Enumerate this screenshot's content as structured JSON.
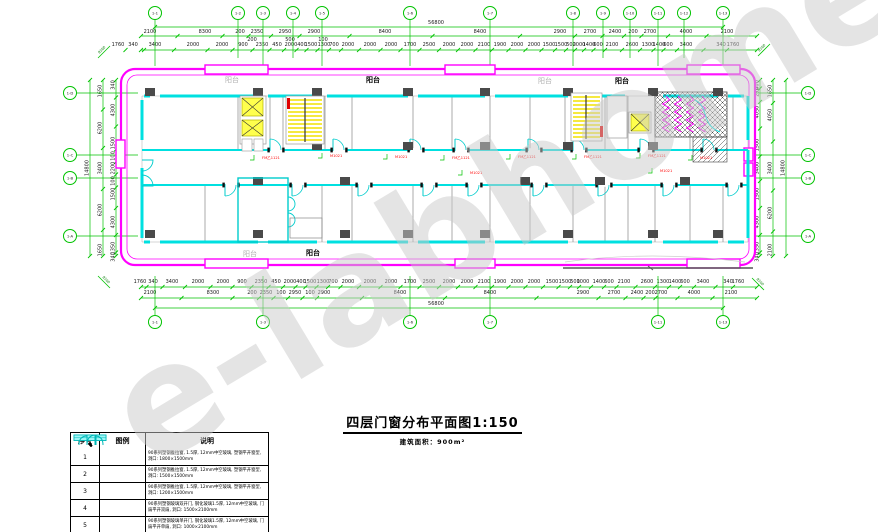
{
  "watermark": "e-labhome",
  "title": {
    "text": "四层门窗分布平面图1:150",
    "subtitle": "建筑面积：900m²"
  },
  "legend": {
    "headers": [
      "序号",
      "图例",
      "说明"
    ],
    "rows": [
      {
        "no": "1",
        "symbol": "window",
        "desc": "90系列塑钢推拉窗, 1.5厚, 12mm中空玻璃, 塑钢平开窗型, 洞口: 1800×1500mm"
      },
      {
        "no": "2",
        "symbol": "window",
        "desc": "90系列塑钢推拉窗, 1.5厚, 12mm中空玻璃, 塑钢平开窗型, 洞口: 1500×1500mm"
      },
      {
        "no": "3",
        "symbol": "window",
        "desc": "90系列塑钢推拉窗, 1.5厚, 12mm中空玻璃, 塑钢平开窗型, 洞口: 1200×1500mm"
      },
      {
        "no": "4",
        "symbol": "double-door",
        "desc": "90系列塑钢玻璃双开门, 钢化玻璃1.5厚, 12mm中空玻璃, 门扇平开双扇, 洞口: 1500×2100mm"
      },
      {
        "no": "5",
        "symbol": "single-door",
        "desc": "90系列塑钢玻璃单开门, 钢化玻璃1.5厚, 12mm中空玻璃, 门扇平开单扇, 洞口: 1000×2100mm"
      }
    ]
  },
  "drawing": {
    "balcony_labels": [
      {
        "text": "阳台",
        "x": 232,
        "y": 82,
        "shade": "light"
      },
      {
        "text": "阳台",
        "x": 373,
        "y": 82,
        "shade": "dark"
      },
      {
        "text": "阳台",
        "x": 545,
        "y": 83,
        "shade": "light"
      },
      {
        "text": "阳台",
        "x": 622,
        "y": 83,
        "shade": "dark"
      },
      {
        "text": "阳台",
        "x": 250,
        "y": 256,
        "shade": "light"
      },
      {
        "text": "阳台",
        "x": 313,
        "y": 255,
        "shade": "dark"
      }
    ],
    "grid_bubbles": {
      "top": {
        "cy": 13,
        "stem": [
          20,
          58
        ],
        "main_stem": 66,
        "items": [
          {
            "x": 155,
            "label": "1-1",
            "main": true
          },
          {
            "x": 238,
            "label": "1-2"
          },
          {
            "x": 263,
            "label": "1-3",
            "main": true
          },
          {
            "x": 293,
            "label": "1-4"
          },
          {
            "x": 322,
            "label": "1-5",
            "main": true
          },
          {
            "x": 410,
            "label": "1-6",
            "main": true
          },
          {
            "x": 490,
            "label": "1-7",
            "main": true
          },
          {
            "x": 573,
            "label": "1-8",
            "main": true
          },
          {
            "x": 603,
            "label": "1-9"
          },
          {
            "x": 630,
            "label": "1-10"
          },
          {
            "x": 658,
            "label": "1-11",
            "main": true
          },
          {
            "x": 684,
            "label": "1-12"
          },
          {
            "x": 723,
            "label": "1-13",
            "main": true
          }
        ]
      },
      "bottom": {
        "cy": 322,
        "stem": [
          276,
          315
        ],
        "main_stem": 276,
        "items": [
          {
            "x": 155,
            "label": "1-1"
          },
          {
            "x": 263,
            "label": "1-3"
          },
          {
            "x": 410,
            "label": "1-6"
          },
          {
            "x": 490,
            "label": "1-7"
          },
          {
            "x": 658,
            "label": "1-11"
          },
          {
            "x": 723,
            "label": "1-13"
          }
        ]
      },
      "left": {
        "cx": 70,
        "stem": [
          77,
          138
        ],
        "items": [
          {
            "y": 93,
            "label": "1-D"
          },
          {
            "y": 155,
            "label": "1-C"
          },
          {
            "y": 178,
            "label": "1-B"
          },
          {
            "y": 236,
            "label": "1-A"
          }
        ]
      },
      "right": {
        "cx": 808,
        "stem": [
          755,
          801
        ],
        "items": [
          {
            "y": 93,
            "label": "1-D"
          },
          {
            "y": 155,
            "label": "1-C"
          },
          {
            "y": 178,
            "label": "1-B"
          },
          {
            "y": 236,
            "label": "1-A"
          }
        ]
      }
    },
    "dim_rows_h": [
      {
        "y": 24,
        "line": {
          "y": 27,
          "x1": 155,
          "x2": 723
        },
        "items": [
          {
            "x": 436,
            "label": "56800"
          }
        ]
      },
      {
        "y": 33,
        "line": {
          "y": 36,
          "x1": 141,
          "x2": 757
        },
        "items": [
          {
            "x": 150,
            "label": "2100"
          },
          {
            "x": 205,
            "label": "8300"
          },
          {
            "x": 240,
            "label": "200"
          },
          {
            "x": 257,
            "label": "2350"
          },
          {
            "x": 285,
            "label": "2950"
          },
          {
            "x": 314,
            "label": "2900"
          },
          {
            "x": 385,
            "label": "8400"
          },
          {
            "x": 480,
            "label": "8400"
          },
          {
            "x": 560,
            "label": "2900"
          },
          {
            "x": 590,
            "label": "2700"
          },
          {
            "x": 615,
            "label": "2400"
          },
          {
            "x": 633,
            "label": "200"
          },
          {
            "x": 650,
            "label": "2700"
          },
          {
            "x": 686,
            "label": "4000"
          },
          {
            "x": 727,
            "label": "2100"
          }
        ]
      },
      {
        "y": 41,
        "items": [
          {
            "x": 252,
            "label": "200"
          },
          {
            "x": 290,
            "label": "500"
          },
          {
            "x": 323,
            "label": "100"
          }
        ]
      },
      {
        "y": 46,
        "line": {
          "y": 50,
          "x1": 141,
          "x2": 757
        },
        "items": [
          {
            "x": 118,
            "label": "1760"
          },
          {
            "x": 133,
            "label": "340"
          },
          {
            "x": 155,
            "label": "3400"
          },
          {
            "x": 193,
            "label": "2000"
          },
          {
            "x": 222,
            "label": "2000"
          },
          {
            "x": 243,
            "label": "900"
          },
          {
            "x": 262,
            "label": "2350"
          },
          {
            "x": 277,
            "label": "450"
          },
          {
            "x": 291,
            "label": "2000"
          },
          {
            "x": 302,
            "label": "400"
          },
          {
            "x": 311,
            "label": "1500"
          },
          {
            "x": 324,
            "label": "1300"
          },
          {
            "x": 334,
            "label": "700"
          },
          {
            "x": 348,
            "label": "2000"
          },
          {
            "x": 370,
            "label": "2000"
          },
          {
            "x": 391,
            "label": "2000"
          },
          {
            "x": 410,
            "label": "1700"
          },
          {
            "x": 429,
            "label": "2500"
          },
          {
            "x": 449,
            "label": "2000"
          },
          {
            "x": 467,
            "label": "2000"
          },
          {
            "x": 484,
            "label": "2100"
          },
          {
            "x": 500,
            "label": "1900"
          },
          {
            "x": 517,
            "label": "2000"
          },
          {
            "x": 534,
            "label": "2000"
          },
          {
            "x": 549,
            "label": "1500"
          },
          {
            "x": 561,
            "label": "1500"
          },
          {
            "x": 571,
            "label": "500"
          },
          {
            "x": 579,
            "label": "2000"
          },
          {
            "x": 589,
            "label": "1400"
          },
          {
            "x": 598,
            "label": "600"
          },
          {
            "x": 612,
            "label": "2100"
          },
          {
            "x": 632,
            "label": "2600"
          },
          {
            "x": 648,
            "label": "1300"
          },
          {
            "x": 659,
            "label": "1400"
          },
          {
            "x": 668,
            "label": "600"
          },
          {
            "x": 686,
            "label": "3400"
          },
          {
            "x": 721,
            "label": "340"
          },
          {
            "x": 733,
            "label": "1760"
          }
        ]
      },
      {
        "y": 283,
        "line": {
          "y": 287,
          "x1": 141,
          "x2": 757
        },
        "items": [
          {
            "x": 140,
            "label": "1760"
          },
          {
            "x": 153,
            "label": "340"
          },
          {
            "x": 172,
            "label": "3400"
          },
          {
            "x": 198,
            "label": "2000"
          },
          {
            "x": 223,
            "label": "2000"
          },
          {
            "x": 242,
            "label": "900"
          },
          {
            "x": 261,
            "label": "2350"
          },
          {
            "x": 276,
            "label": "450"
          },
          {
            "x": 290,
            "label": "2000"
          },
          {
            "x": 301,
            "label": "400"
          },
          {
            "x": 310,
            "label": "1500"
          },
          {
            "x": 323,
            "label": "1300"
          },
          {
            "x": 333,
            "label": "700"
          },
          {
            "x": 348,
            "label": "2000"
          },
          {
            "x": 370,
            "label": "2000"
          },
          {
            "x": 391,
            "label": "2000"
          },
          {
            "x": 410,
            "label": "1700"
          },
          {
            "x": 429,
            "label": "2500"
          },
          {
            "x": 449,
            "label": "2000"
          },
          {
            "x": 467,
            "label": "2000"
          },
          {
            "x": 484,
            "label": "2100"
          },
          {
            "x": 500,
            "label": "1900"
          },
          {
            "x": 517,
            "label": "2000"
          },
          {
            "x": 534,
            "label": "2000"
          },
          {
            "x": 552,
            "label": "1500"
          },
          {
            "x": 565,
            "label": "1500"
          },
          {
            "x": 575,
            "label": "500"
          },
          {
            "x": 583,
            "label": "1000"
          },
          {
            "x": 599,
            "label": "1400"
          },
          {
            "x": 609,
            "label": "600"
          },
          {
            "x": 624,
            "label": "2100"
          },
          {
            "x": 647,
            "label": "2600"
          },
          {
            "x": 663,
            "label": "1300"
          },
          {
            "x": 675,
            "label": "1400"
          },
          {
            "x": 685,
            "label": "600"
          },
          {
            "x": 703,
            "label": "3400"
          },
          {
            "x": 728,
            "label": "340"
          },
          {
            "x": 738,
            "label": "1760"
          }
        ]
      },
      {
        "y": 294,
        "line": {
          "y": 298,
          "x1": 141,
          "x2": 757
        },
        "items": [
          {
            "x": 150,
            "label": "2100"
          },
          {
            "x": 213,
            "label": "8300"
          },
          {
            "x": 252,
            "label": "200"
          },
          {
            "x": 266,
            "label": "2350"
          },
          {
            "x": 281,
            "label": "100"
          },
          {
            "x": 295,
            "label": "2950"
          },
          {
            "x": 310,
            "label": "100"
          },
          {
            "x": 324,
            "label": "2900"
          },
          {
            "x": 400,
            "label": "8400"
          },
          {
            "x": 490,
            "label": "8400"
          },
          {
            "x": 583,
            "label": "2900"
          },
          {
            "x": 614,
            "label": "2700"
          },
          {
            "x": 637,
            "label": "2400"
          },
          {
            "x": 650,
            "label": "200"
          },
          {
            "x": 661,
            "label": "2700"
          },
          {
            "x": 694,
            "label": "4000"
          },
          {
            "x": 731,
            "label": "2100"
          }
        ]
      },
      {
        "y": 305,
        "line": {
          "y": 308,
          "x1": 155,
          "x2": 723
        },
        "items": [
          {
            "x": 436,
            "label": "56800"
          }
        ]
      }
    ],
    "dim_cols_v": [
      {
        "x": 90,
        "y1": 80,
        "y2": 256,
        "items": [
          {
            "y": 168,
            "label": "14800"
          }
        ]
      },
      {
        "x": 103,
        "y1": 80,
        "y2": 256,
        "items": [
          {
            "y": 91,
            "label": "1650"
          },
          {
            "y": 128,
            "label": "6200"
          },
          {
            "y": 168,
            "label": "3400"
          },
          {
            "y": 210,
            "label": "6200"
          },
          {
            "y": 250,
            "label": "1650"
          }
        ]
      },
      {
        "x": 116,
        "y1": 80,
        "y2": 256,
        "items": [
          {
            "y": 85,
            "label": "340"
          },
          {
            "y": 110,
            "label": "4300"
          },
          {
            "y": 143,
            "label": "1500"
          },
          {
            "y": 156,
            "label": "100"
          },
          {
            "y": 168,
            "label": "2200"
          },
          {
            "y": 181,
            "label": "100"
          },
          {
            "y": 194,
            "label": "1500"
          },
          {
            "y": 222,
            "label": "4300"
          },
          {
            "y": 248,
            "label": "1350"
          },
          {
            "y": 257,
            "label": "340"
          }
        ]
      },
      {
        "x": 760,
        "y1": 80,
        "y2": 256,
        "items": [
          {
            "y": 85,
            "label": "400"
          },
          {
            "y": 92,
            "label": "250"
          },
          {
            "y": 112,
            "label": "4050"
          },
          {
            "y": 145,
            "label": "1500"
          },
          {
            "y": 168,
            "label": "3400"
          },
          {
            "y": 194,
            "label": "1500"
          },
          {
            "y": 222,
            "label": "4300"
          },
          {
            "y": 248,
            "label": "1350"
          },
          {
            "y": 257,
            "label": "340"
          }
        ]
      },
      {
        "x": 773,
        "y1": 80,
        "y2": 256,
        "items": [
          {
            "y": 91,
            "label": "1650"
          },
          {
            "y": 115,
            "label": "4050"
          },
          {
            "y": 168,
            "label": "3400"
          },
          {
            "y": 213,
            "label": "6200"
          },
          {
            "y": 250,
            "label": "2100"
          }
        ]
      },
      {
        "x": 786,
        "y1": 80,
        "y2": 256,
        "items": [
          {
            "y": 168,
            "label": "14800"
          }
        ]
      }
    ],
    "corner_notes": [
      {
        "x": 104,
        "y": 52,
        "label": "8100",
        "a": -45
      },
      {
        "x": 764,
        "y": 50,
        "label": "8100",
        "a": -45
      },
      {
        "x": 104,
        "y": 282,
        "label": "8100",
        "a": 45
      },
      {
        "x": 758,
        "y": 284,
        "label": "8100",
        "a": 45
      }
    ],
    "red_labels": [
      {
        "x": 262,
        "y": 159,
        "text": "FM乙1121"
      },
      {
        "x": 330,
        "y": 157,
        "text": "M1021"
      },
      {
        "x": 395,
        "y": 158,
        "text": "M1021"
      },
      {
        "x": 452,
        "y": 159,
        "text": "FM乙1121"
      },
      {
        "x": 518,
        "y": 158,
        "text": "FM乙1121"
      },
      {
        "x": 584,
        "y": 158,
        "text": "FM乙1121"
      },
      {
        "x": 648,
        "y": 157,
        "text": "FM乙1121"
      },
      {
        "x": 700,
        "y": 159,
        "text": "M1021"
      },
      {
        "x": 470,
        "y": 174,
        "text": "M1021"
      },
      {
        "x": 660,
        "y": 172,
        "text": "M1021"
      }
    ],
    "doors": {
      "top": {
        "y": 150,
        "x": [
          270,
          333,
          410,
          455,
          528,
          573,
          640,
          703
        ]
      },
      "bottom": {
        "y": 185,
        "x": [
          225,
          292,
          358,
          423,
          468,
          533,
          598,
          663,
          728
        ]
      }
    },
    "columns": [
      {
        "y": 92,
        "x": [
          150,
          258,
          317,
          408,
          485,
          568,
          653,
          718
        ]
      },
      {
        "y": 146,
        "x": [
          317,
          408,
          485,
          568,
          653
        ]
      },
      {
        "y": 181,
        "x": [
          258,
          345,
          525,
          600,
          685
        ]
      },
      {
        "y": 234,
        "x": [
          150,
          258,
          345,
          408,
          485,
          568,
          653,
          718
        ]
      }
    ],
    "stairs": [
      {
        "x1": 288,
        "x2": 322,
        "y1": 100,
        "y2": 140,
        "step": 4,
        "rail": 305,
        "red": [
          287,
          98
        ],
        "frame": [
          286,
          96,
          38,
          48
        ]
      },
      {
        "x1": 573,
        "x2": 600,
        "y1": 97,
        "y2": 137,
        "step": 4,
        "rail": 586,
        "red": [
          600,
          126
        ],
        "frame": [
          571,
          93,
          31,
          48
        ]
      }
    ],
    "zigzags": {
      "xs": [
        666,
        678,
        690,
        702
      ],
      "y1": 96,
      "y2": 134
    }
  }
}
